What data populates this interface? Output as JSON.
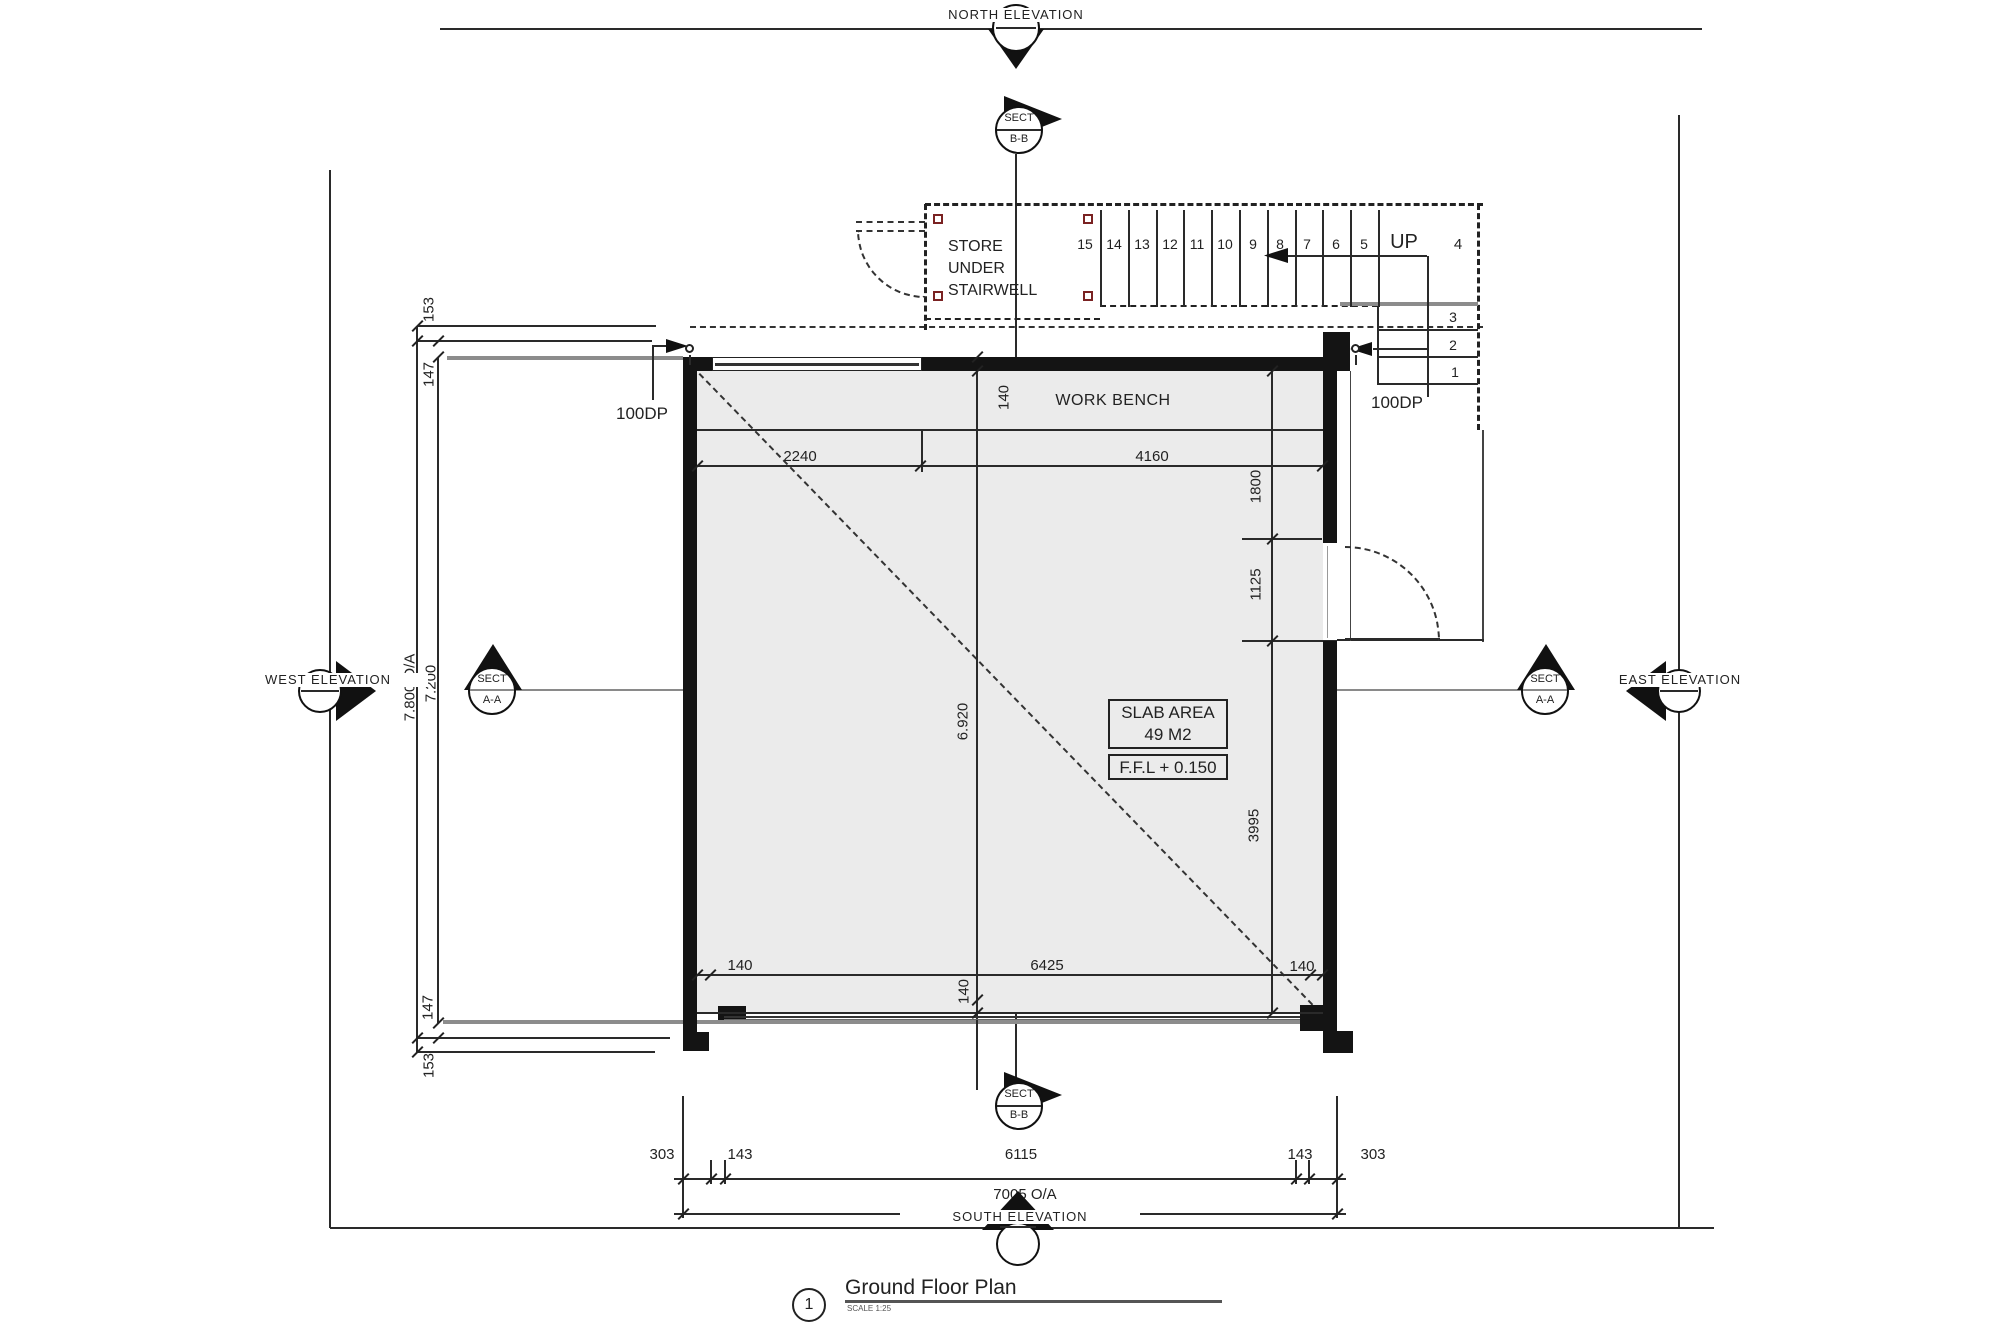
{
  "colors": {
    "wall": "#141414",
    "floor": "#ebebeb",
    "gray_line": "#8c8c8c",
    "red_post": "#7a2222"
  },
  "title_block": {
    "number": "1",
    "title": "Ground Floor Plan",
    "scale": "SCALE 1:25"
  },
  "elevations": {
    "north": "NORTH ELEVATION",
    "south": "SOUTH ELEVATION",
    "west": "WEST ELEVATION",
    "east": "EAST ELEVATION"
  },
  "sections": {
    "label": "SECT",
    "aa": "A-A",
    "bb": "B-B"
  },
  "stair": {
    "up": "UP",
    "treads_run": [
      "15",
      "14",
      "13",
      "12",
      "11",
      "10",
      "9",
      "8",
      "7",
      "6",
      "5"
    ],
    "landing": "4",
    "lower": [
      "3",
      "2",
      "1"
    ]
  },
  "store": {
    "line1": "STORE",
    "line2": "UNDER",
    "line3": "STAIRWELL"
  },
  "room": {
    "workbench": "WORK BENCH",
    "slab1": "SLAB AREA",
    "slab2": "49 M2",
    "ffl": "F.F.L + 0.150"
  },
  "downpipe": "100DP",
  "dims": {
    "tl_outer": "153",
    "tl_inner": "147",
    "left_overall": "7.800 O/A",
    "left_wall": "7.200",
    "bl_inner": "147",
    "bl_outer": "153",
    "top_left": "2240",
    "top_right": "4160",
    "wall_thk": "140",
    "door_above": "1800",
    "door_width": "1125",
    "door_below": "3995",
    "diag": "6.920",
    "bot_140l": "140",
    "bot_6425": "6425",
    "bot_140r": "140",
    "bot_140c": "140",
    "row1": [
      "303",
      "143",
      "6115",
      "143",
      "303"
    ],
    "overall_w": "7005 O/A"
  }
}
